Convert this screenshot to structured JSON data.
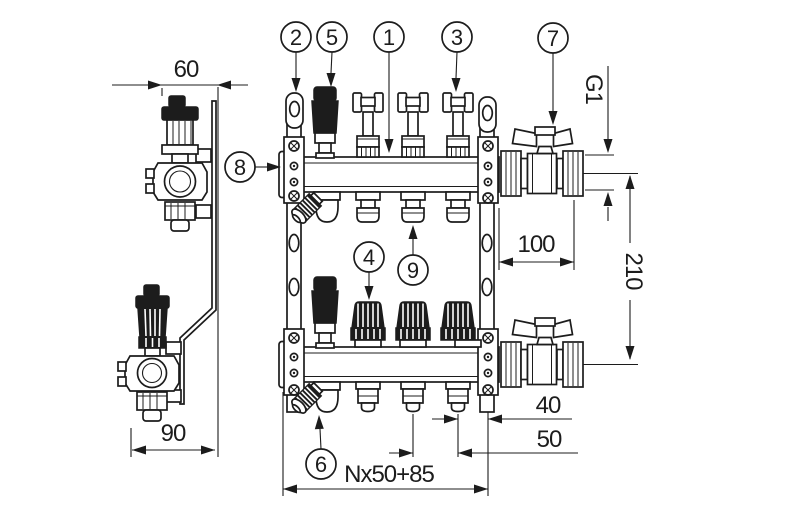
{
  "callouts": {
    "manifold_body": "1",
    "bracket": "2",
    "valve_handwheel": "3",
    "thermostatic_insert": "4",
    "air_vent": "5",
    "drain_valve": "6",
    "ball_valve": "7",
    "end_plug": "8",
    "outlet_connection": "9"
  },
  "dimensions": {
    "bracket_depth_top": "60",
    "bracket_depth_bottom": "90",
    "ball_valve_length": "100",
    "thread_size": "G1",
    "axis_spacing": "210",
    "last_outlet_to_bracket": "40",
    "outlet_spacing": "50",
    "total_length_formula": "Nx50+85"
  },
  "colors": {
    "line": "#1c1c1c",
    "background": "#ffffff"
  }
}
